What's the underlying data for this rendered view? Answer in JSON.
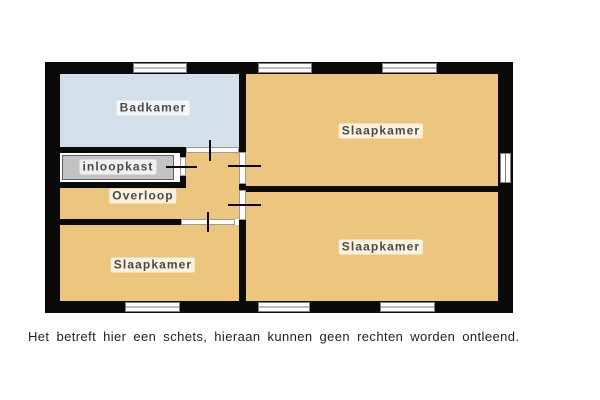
{
  "floorplan": {
    "rooms": [
      {
        "name": "badkamer",
        "label": "Badkamer",
        "fill": "#d3e0ec"
      },
      {
        "name": "inloopkast",
        "label": "inloopkast",
        "fill": "#c3c3c3"
      },
      {
        "name": "overloop",
        "label": "Overloop",
        "fill": "#ecc57e"
      },
      {
        "name": "slaapkamer-bottom-left",
        "label": "Slaapkamer",
        "fill": "#ecc57e"
      },
      {
        "name": "slaapkamer-top-right",
        "label": "Slaapkamer",
        "fill": "#ecc57e"
      },
      {
        "name": "slaapkamer-bottom-right",
        "label": "Slaapkamer",
        "fill": "#ecc57e"
      }
    ],
    "colors": {
      "wall": "#0a0a0a",
      "window_frame": "#7f7f7f",
      "door_jamb": "#9a9a9a",
      "label_text": "#4a4a4a",
      "background": "#ffffff"
    },
    "counts": {
      "windows": 7,
      "doors": 5
    }
  },
  "disclaimer": "Het betreft hier een schets, hieraan kunnen geen rechten worden ontleend."
}
